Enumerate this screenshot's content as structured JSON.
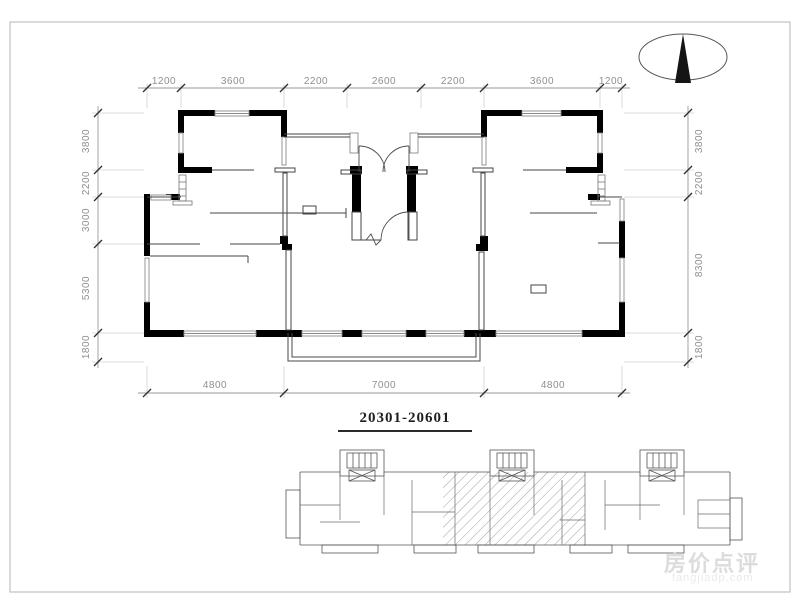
{
  "drawing": {
    "title": "20301-20601",
    "dimensions": {
      "top": [
        "1200",
        "3600",
        "2200",
        "2600",
        "2200",
        "3600",
        "1200"
      ],
      "bottom": [
        "4800",
        "7000",
        "4800"
      ],
      "left": [
        "3800",
        "2200",
        "3000",
        "5300",
        "1800"
      ],
      "right": [
        "3800",
        "2200",
        "8300",
        "1800"
      ]
    }
  },
  "icons": {
    "north_arrow": "north-arrow"
  },
  "watermark": {
    "line1": "房价点评",
    "line2": "fangjiadp.com"
  },
  "colors": {
    "walls": "#000000",
    "lines": "#454545",
    "dims": "#8f8f8f",
    "watermark": "#dcdcdc"
  }
}
